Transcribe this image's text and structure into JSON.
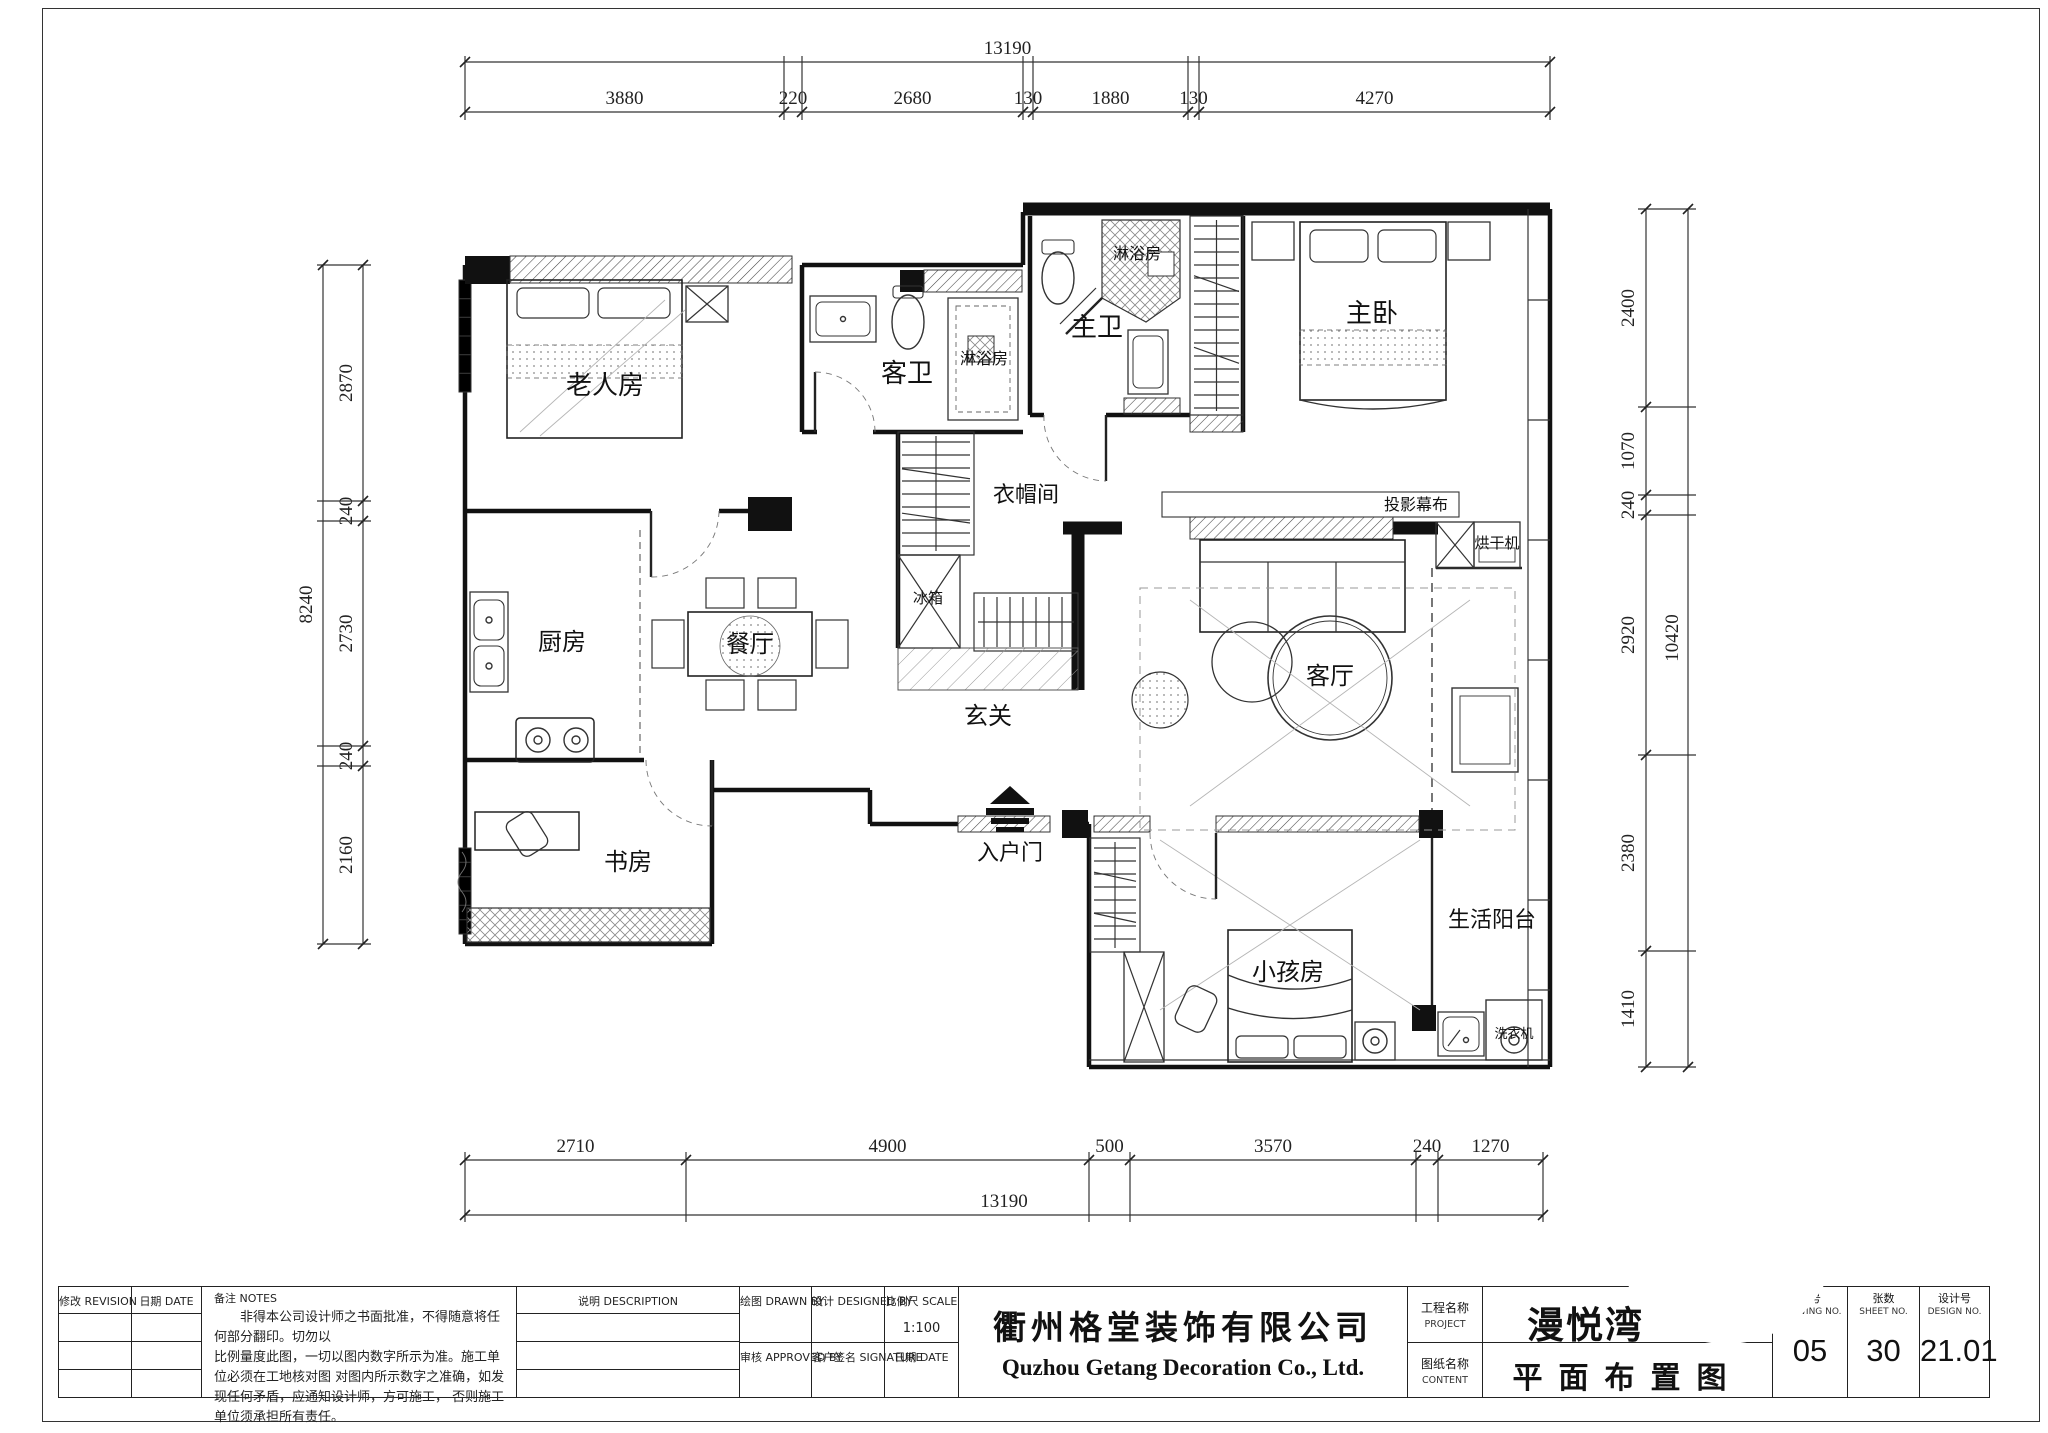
{
  "sheet": {
    "title_block": {
      "revision_label": "修改  REVISION",
      "date_label": "日期  DATE",
      "notes_label": "备注   NOTES",
      "notes_lines": [
        "非得本公司设计师之书面批准，不得随意将任何部分翻印。切勿以",
        "比例量度此图，一切以图内数字所示为准。施工单位必须在工地核对图",
        "对图内所示数字之准确，如发现任何矛盾，应通知设计师，方可施工，",
        "否则施工单位须承担所有责任。"
      ],
      "description_label": "说明   DESCRIPTION",
      "drawn_by_label": "绘图  DRAWN BY",
      "designed_by_label": "设计  DESIGNED BY",
      "scale_label": "比例尺  SCALE",
      "scale_value": "1:100",
      "approved_by_label": "审核  APPROVED BY",
      "signature_label": "客户签名  SIGNATURE",
      "date2_label": "日期   DATE",
      "company_cn": "衢州格堂装饰有限公司",
      "company_en": "Quzhou Getang Decoration Co., Ltd.",
      "project_label_cn": "工程名称",
      "project_label_en": "PROJECT",
      "project_value": "漫悦湾",
      "content_label_cn": "图纸名称",
      "content_label_en": "CONTENT",
      "content_value": "平面布置图",
      "drawing_no_label_cn": "图号",
      "drawing_no_label_en": "DRAWING NO.",
      "drawing_no": "05",
      "sheet_no_label_cn": "张数",
      "sheet_no_label_en": "SHEET NO.",
      "sheet_no": "30",
      "design_no_label_cn": "设计号",
      "design_no_label_en": "DESIGN NO.",
      "design_no": "21.01"
    }
  },
  "plan": {
    "rooms": [
      {
        "id": "elderly-room",
        "label": "老人房"
      },
      {
        "id": "guest-bath",
        "label": "客卫"
      },
      {
        "id": "guest-shower",
        "label": "淋浴房"
      },
      {
        "id": "master-bath",
        "label": "主卫"
      },
      {
        "id": "master-shower",
        "label": "淋浴房"
      },
      {
        "id": "master-bedroom",
        "label": "主卧"
      },
      {
        "id": "cloakroom",
        "label": "衣帽间"
      },
      {
        "id": "fridge",
        "label": "冰箱"
      },
      {
        "id": "kitchen",
        "label": "厨房"
      },
      {
        "id": "dining-room",
        "label": "餐厅"
      },
      {
        "id": "foyer",
        "label": "玄关"
      },
      {
        "id": "living-room",
        "label": "客厅"
      },
      {
        "id": "projection-screen",
        "label": "投影幕布"
      },
      {
        "id": "dryer",
        "label": "烘干机"
      },
      {
        "id": "study",
        "label": "书房"
      },
      {
        "id": "entry-door",
        "label": "入户门"
      },
      {
        "id": "kids-room",
        "label": "小孩房"
      },
      {
        "id": "service-balcony",
        "label": "生活阳台"
      },
      {
        "id": "washing-machine",
        "label": "洗衣机"
      }
    ],
    "dimensions": {
      "top": {
        "total": "13190",
        "segments": [
          "3880",
          "220",
          "2680",
          "130",
          "1880",
          "130",
          "4270"
        ]
      },
      "bottom": {
        "total": "13190",
        "segments": [
          "2710",
          "4900",
          "500",
          "3570",
          "240",
          "1270"
        ]
      },
      "left": {
        "total": "8240",
        "segments": [
          "2870",
          "240",
          "2730",
          "240",
          "2160"
        ]
      },
      "right": {
        "total": "10420",
        "segments": [
          "2400",
          "1070",
          "240",
          "2920",
          "2380",
          "1410"
        ]
      }
    }
  }
}
